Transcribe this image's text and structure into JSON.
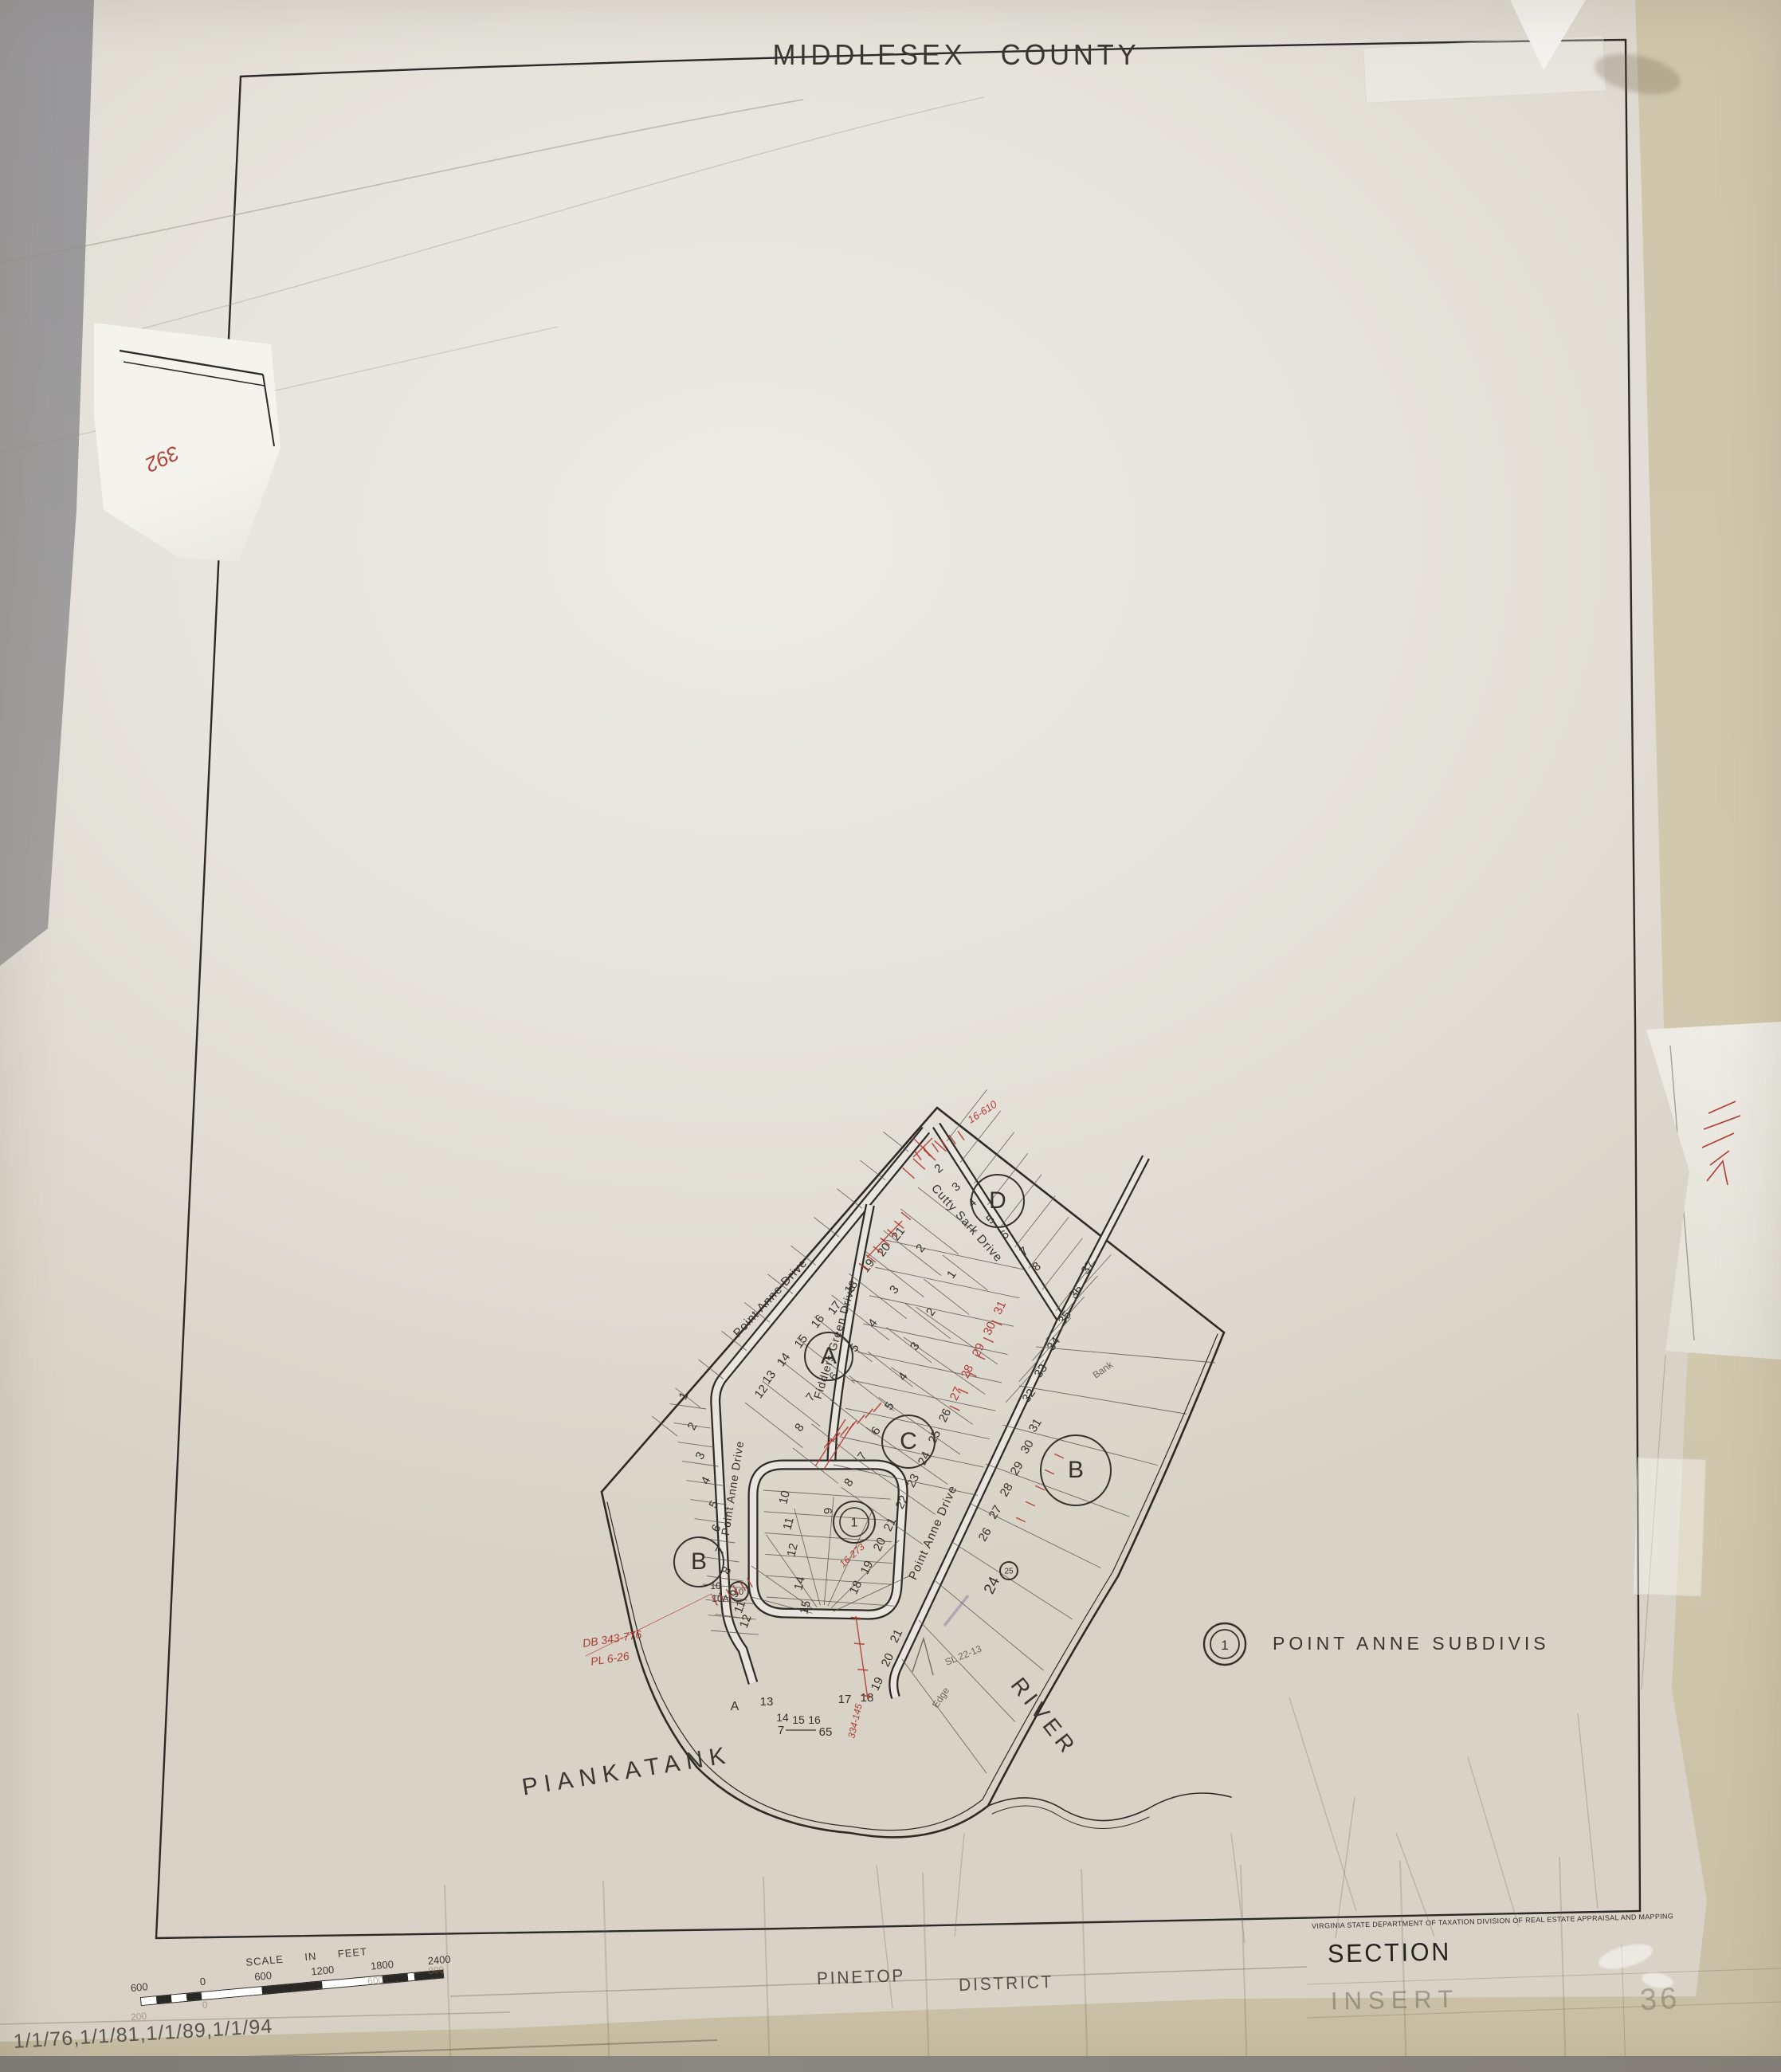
{
  "title": "MIDDLESEX COUNTY",
  "legend": {
    "symbol": "1",
    "label": "POINT ANNE SUBDIVISION"
  },
  "plat": {
    "streets": [
      [
        "Point Anne Drive",
        330,
        292,
        -47,
        15,
        1
      ],
      [
        "Point Anne Drive",
        284,
        528,
        -81,
        14,
        1
      ],
      [
        "Fiddlers Green Drive",
        412,
        345,
        -73,
        14,
        1
      ],
      [
        "Cutty Sark Drive",
        570,
        198,
        48,
        15,
        1
      ],
      [
        "Point Anne Drive",
        535,
        585,
        -66,
        15,
        1
      ]
    ],
    "water_labels": [
      [
        "PIANKATANK",
        148,
        892,
        -9,
        30,
        8
      ],
      [
        "RIVER",
        663,
        820,
        52,
        28,
        6
      ]
    ],
    "blocks": [
      [
        "A",
        400,
        362,
        30
      ],
      [
        "B",
        237,
        620,
        31
      ],
      [
        "C",
        500,
        469,
        33
      ],
      [
        "B",
        710,
        505,
        44
      ],
      [
        "D",
        612,
        167,
        33
      ]
    ],
    "lots": [
      [
        "1",
        222,
        414,
        -62
      ],
      [
        "2",
        233,
        452,
        -62
      ],
      [
        "3",
        243,
        489,
        -62
      ],
      [
        "4",
        250,
        520,
        -62
      ],
      [
        "5",
        260,
        550,
        -62
      ],
      [
        "6",
        263,
        580,
        -62
      ],
      [
        "7",
        268,
        608,
        -62
      ],
      [
        "8",
        276,
        633,
        -62
      ],
      [
        "9",
        286,
        662,
        -62
      ],
      [
        "10",
        258,
        654,
        0,
        12
      ],
      [
        "10A",
        264,
        670,
        0,
        12
      ],
      [
        "11",
        293,
        678,
        -70
      ],
      [
        "12",
        300,
        696,
        -70
      ],
      [
        "12",
        319,
        409,
        -53
      ],
      [
        "13",
        329,
        391,
        -53
      ],
      [
        "14",
        347,
        369,
        -53
      ],
      [
        "15",
        369,
        346,
        -53
      ],
      [
        "16",
        390,
        321,
        -53
      ],
      [
        "17",
        411,
        304,
        -53
      ],
      [
        "18",
        432,
        278,
        -53
      ],
      [
        "19",
        453,
        251,
        -53
      ],
      [
        "20",
        473,
        231,
        -53
      ],
      [
        "21",
        491,
        211,
        -53
      ],
      [
        "2",
        519,
        229,
        -53
      ],
      [
        "3",
        486,
        281,
        -53
      ],
      [
        "4",
        459,
        323,
        -53
      ],
      [
        "5",
        436,
        354,
        -53
      ],
      [
        "6",
        410,
        390,
        -53
      ],
      [
        "7",
        381,
        416,
        -53
      ],
      [
        "8",
        367,
        454,
        -53
      ],
      [
        "2",
        541,
        130,
        -40
      ],
      [
        "3",
        563,
        153,
        -40
      ],
      [
        "4",
        583,
        173,
        -40
      ],
      [
        "5",
        606,
        194,
        -40
      ],
      [
        "6",
        624,
        213,
        -40
      ],
      [
        "7",
        648,
        234,
        -40
      ],
      [
        "8",
        664,
        253,
        -40
      ],
      [
        "1",
        558,
        262,
        -55
      ],
      [
        "2",
        532,
        309,
        -55
      ],
      [
        "3",
        512,
        352,
        -55
      ],
      [
        "4",
        497,
        390,
        -55
      ],
      [
        "5",
        480,
        427,
        -55
      ],
      [
        "6",
        463,
        458,
        -55
      ],
      [
        "7",
        446,
        490,
        -55
      ],
      [
        "8",
        429,
        523,
        -55
      ],
      [
        "18",
        438,
        654,
        -64
      ],
      [
        "19",
        452,
        629,
        -64
      ],
      [
        "20",
        468,
        600,
        -64
      ],
      [
        "21",
        481,
        575,
        -64
      ],
      [
        "22",
        496,
        547,
        -64
      ],
      [
        "23",
        510,
        520,
        -64
      ],
      [
        "24",
        524,
        492,
        -64
      ],
      [
        "25",
        537,
        465,
        -64
      ],
      [
        "26",
        550,
        438,
        -64
      ],
      [
        "27",
        564,
        411,
        -64,
        15,
        "red"
      ],
      [
        "28",
        578,
        383,
        -64,
        15,
        "red"
      ],
      [
        "29",
        592,
        356,
        -64,
        15,
        "red"
      ],
      [
        "30",
        606,
        329,
        -64,
        15,
        "red"
      ],
      [
        "31",
        619,
        303,
        -64,
        15,
        "red"
      ],
      [
        "26",
        600,
        588,
        -58
      ],
      [
        "27",
        613,
        560,
        -58
      ],
      [
        "28",
        627,
        532,
        -58
      ],
      [
        "29",
        640,
        505,
        -58
      ],
      [
        "30",
        653,
        478,
        -58
      ],
      [
        "31",
        663,
        451,
        -58
      ],
      [
        "32",
        655,
        414,
        -55
      ],
      [
        "33",
        670,
        383,
        -55
      ],
      [
        "34",
        686,
        349,
        -55
      ],
      [
        "35",
        700,
        316,
        -55
      ],
      [
        "36",
        714,
        284,
        -55
      ],
      [
        "37",
        729,
        253,
        -55
      ],
      [
        "24",
        610,
        652,
        -64,
        19
      ],
      [
        "9",
        404,
        556,
        -90
      ],
      [
        "10",
        349,
        540,
        -76
      ],
      [
        "11",
        354,
        573,
        -76
      ],
      [
        "12",
        359,
        606,
        -76
      ],
      [
        "14",
        368,
        648,
        -76
      ],
      [
        "15",
        375,
        678,
        -76
      ],
      [
        "A",
        282,
        806,
        0,
        16
      ],
      [
        "13",
        322,
        800,
        0
      ],
      [
        "14",
        342,
        820,
        0,
        14
      ],
      [
        "15",
        362,
        823,
        0,
        14
      ],
      [
        "16",
        382,
        823,
        0,
        14
      ],
      [
        "17",
        420,
        797,
        0
      ],
      [
        "18",
        448,
        795,
        0
      ],
      [
        "19",
        465,
        775,
        -64
      ],
      [
        "20",
        478,
        745,
        -64
      ],
      [
        "21",
        489,
        715,
        -64
      ],
      [
        "7",
        340,
        836,
        0,
        15
      ],
      [
        "65",
        396,
        838,
        0,
        15
      ]
    ],
    "markers": [
      [
        "1",
        432,
        570,
        26,
        18,
        16
      ],
      [
        "10",
        287,
        657,
        12,
        0,
        11
      ],
      [
        "25",
        626,
        631,
        11,
        0,
        10
      ]
    ],
    "red_notes": [
      [
        "16-610",
        578,
        70,
        -33,
        13
      ],
      [
        "16-273",
        418,
        627,
        -42,
        12
      ],
      [
        "334-145",
        432,
        842,
        -77,
        12
      ],
      [
        "DB 343-776",
        92,
        727,
        -9,
        14
      ],
      [
        "PL 6-26",
        102,
        750,
        -9,
        14
      ]
    ],
    "pencil_notes": [
      [
        "SL 22-13",
        548,
        750,
        -22,
        12
      ],
      [
        "Edge",
        536,
        804,
        -56,
        12
      ],
      [
        "Bank",
        735,
        390,
        -35,
        12
      ]
    ]
  },
  "scale_bar": {
    "title": "SCALE IN FEET",
    "labels": [
      "600",
      "0",
      "600",
      "1200",
      "1800",
      "2400"
    ],
    "label_x": [
      12,
      92,
      168,
      243,
      318,
      390
    ],
    "segments": [
      {
        "w": 19,
        "c": "#ffffff"
      },
      {
        "w": 19,
        "c": "#2a2824"
      },
      {
        "w": 19,
        "c": "#ffffff"
      },
      {
        "w": 19,
        "c": "#2a2824"
      },
      {
        "w": 76,
        "c": "#ffffff"
      },
      {
        "w": 76,
        "c": "#2a2824"
      },
      {
        "w": 76,
        "c": "#ffffff"
      },
      {
        "w": 32,
        "c": "#2a2824"
      },
      {
        "w": 8,
        "c": "#ffffff"
      },
      {
        "w": 36,
        "c": "#2a2824"
      }
    ],
    "faint_labels": [
      [
        "200",
        8,
        62
      ],
      [
        "0",
        92,
        55
      ],
      [
        "600",
        308,
        44
      ],
      [
        "800",
        385,
        38
      ]
    ]
  },
  "footer": {
    "agency": "VIRGINIA STATE DEPARTMENT OF TAXATION   DIVISION OF REAL ESTATE APPRAISAL AND MAPPING",
    "district": "PINETOP",
    "district_word": "DISTRICT",
    "section": "SECTION",
    "insert": "INSERT",
    "sheet": "36",
    "revision_dates": "1/1/76,1/1/81,1/1/89,1/1/94"
  },
  "patch": {
    "note": "392"
  },
  "colors": {
    "ink": "#35322d",
    "red": "#b03a36",
    "pencil": "#6b675e",
    "paper": "#e8e5de"
  }
}
